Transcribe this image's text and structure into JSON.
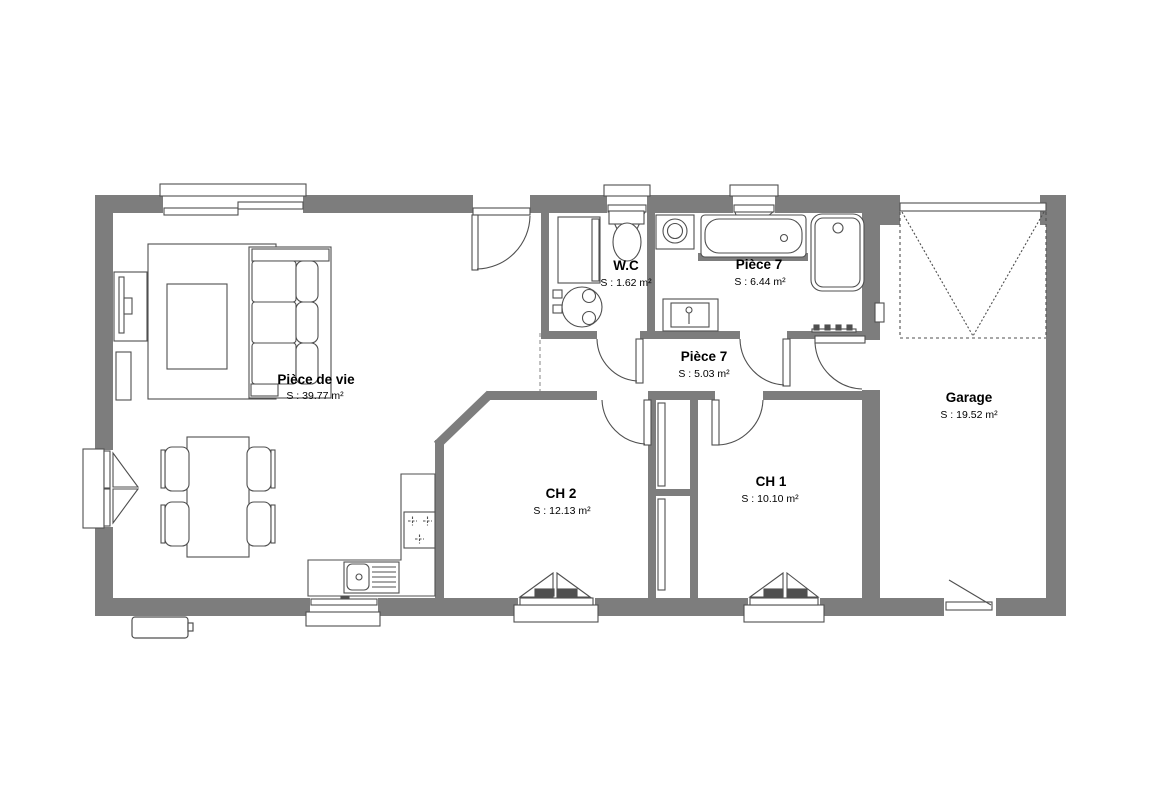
{
  "colors": {
    "wall": "#7d7d7d",
    "line": "#4f4f4f",
    "bg": "#ffffff",
    "text": "#000000"
  },
  "rooms": {
    "living": {
      "name": "Pièce de vie",
      "area": "S : 39.77 m²"
    },
    "wc": {
      "name": "W.C",
      "area": "S : 1.62 m²"
    },
    "bathroom": {
      "name": "Pièce 7",
      "area": "S : 6.44 m²"
    },
    "hallway": {
      "name": "Pièce 7",
      "area": "S : 5.03 m²"
    },
    "bedroom2": {
      "name": "CH 2",
      "area": "S : 12.13 m²"
    },
    "bedroom1": {
      "name": "CH 1",
      "area": "S : 10.10 m²"
    },
    "garage": {
      "name": "Garage",
      "area": "S : 19.52 m²"
    }
  }
}
